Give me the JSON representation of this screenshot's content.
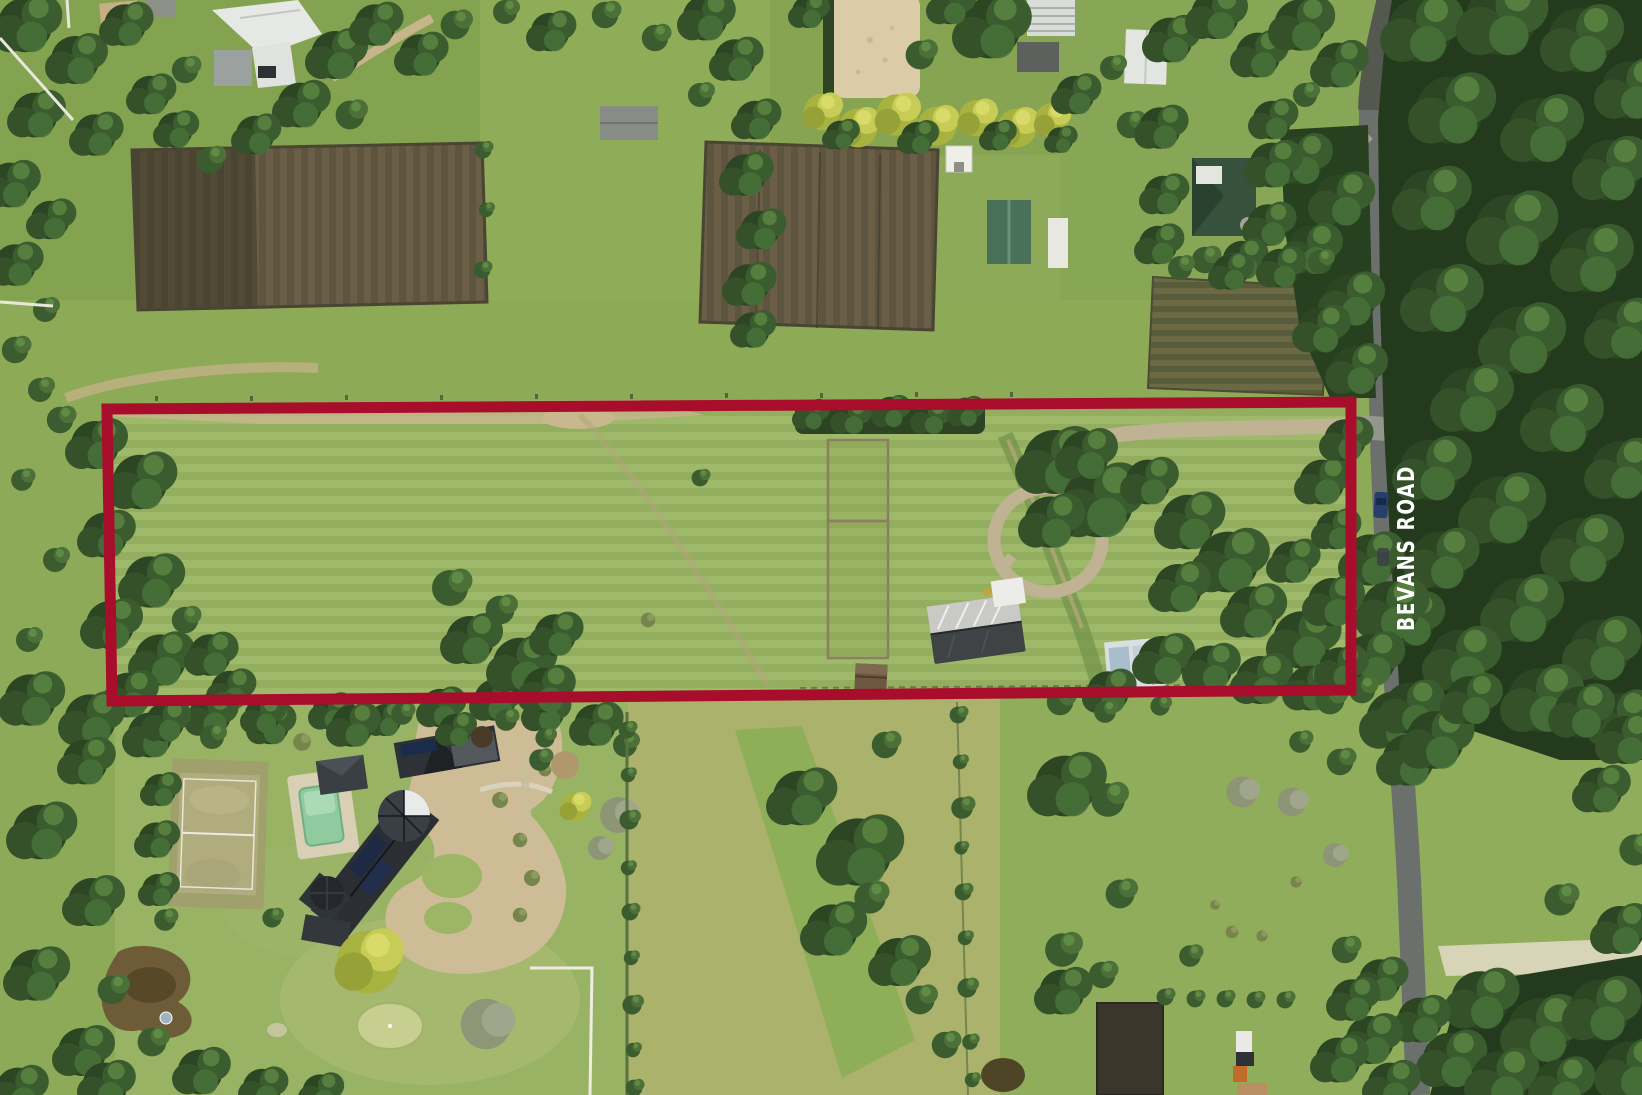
{
  "annotation": {
    "road_label": "BEVANS ROAD",
    "boundary_color": "#A80E2C",
    "label_color": "#FFFFFF"
  },
  "scene": {
    "description": "Aerial drone photograph of semi-rural acreage; a long rectangular grass paddock parcel is outlined in red, bordered by Bevans Road on the east, tilled horse paddocks and a sand arena to the north, and a large landscaped estate with tennis court and pool to the south-west.",
    "palette": {
      "pasture_green": "#9AB563",
      "dry_field": "#ABB26C",
      "forest_dark": "#233A1D",
      "tilled_soil": "#5E5540",
      "sand_arena": "#DCCBA7",
      "asphalt_road": "#6B706C",
      "driveway_tan": "#CDBC95",
      "pool_water": "#8FCB9F",
      "dark_roof": "#2B2F34",
      "white_roof": "#E6E8E6",
      "green_roof": "#49715A"
    }
  }
}
